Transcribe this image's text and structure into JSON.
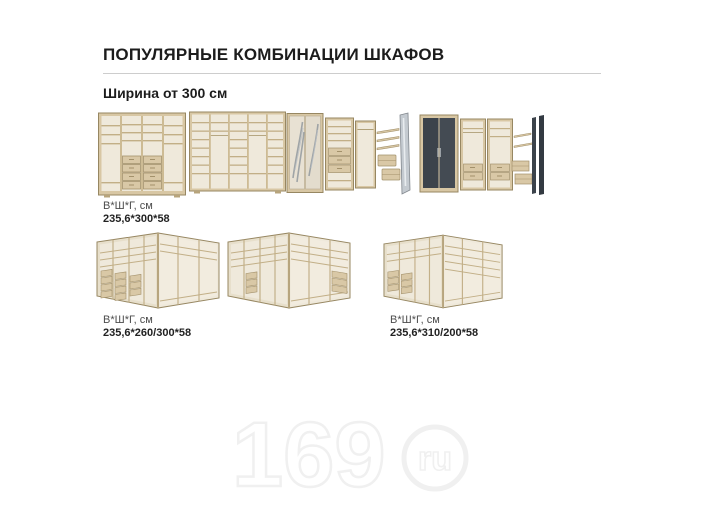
{
  "header": {
    "title": "ПОПУЛЯРНЫЕ КОМБИНАЦИИ ШКАФОВ",
    "subtitle": "Ширина от 300 см"
  },
  "products": [
    {
      "id": "wardrobe-straight-300",
      "dims_title": "В*Ш*Г, см",
      "dims_value": "235,6*300*58"
    },
    {
      "id": "wardrobe-shelving-300"
    },
    {
      "id": "wardrobe-mirror-combo-300"
    },
    {
      "id": "wardrobe-dark-combo-300"
    },
    {
      "id": "corner-wardrobe-260-300",
      "dims_title": "В*Ш*Г, см",
      "dims_value": "235,6*260/300*58"
    },
    {
      "id": "corner-wardrobe-middle"
    },
    {
      "id": "corner-wardrobe-310-200",
      "dims_title": "В*Ш*Г, см",
      "dims_value": "235,6*310/200*58"
    }
  ],
  "watermark": {
    "number": "169",
    "domain": "ru"
  },
  "colors": {
    "wood": "#d8c7a4",
    "wood_edge": "#978762",
    "interior": "#efe9db",
    "dark_door": "#3c434b",
    "divider_line": "#cdcdcd"
  }
}
